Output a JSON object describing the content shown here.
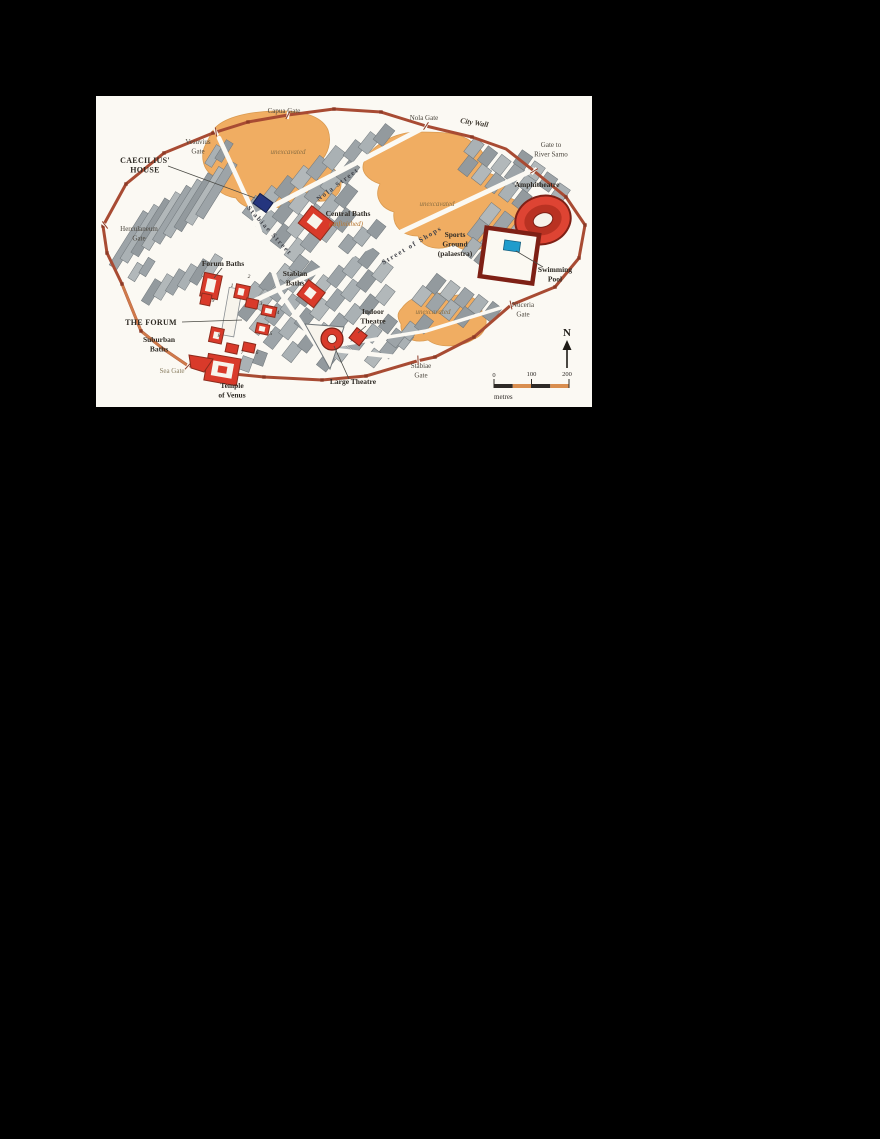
{
  "page": {
    "background": "#000000"
  },
  "map": {
    "colors": {
      "map_background": "#fbf9f3",
      "unexcavated_area": "#f0ad62",
      "city_block": "#9da4a8",
      "city_wall": "#a84b33",
      "public_building": "#d93a2a",
      "caecilius_house": "#24357e",
      "swimming_pool": "#1f9ccc"
    },
    "labels": [
      {
        "id": "capua-gate",
        "text": "Capua Gate",
        "x": 188,
        "y": 17,
        "cls": "gate"
      },
      {
        "id": "nola-gate",
        "text": "Nola Gate",
        "x": 328,
        "y": 24,
        "cls": "gate"
      },
      {
        "id": "city-wall",
        "text": "City Wall",
        "x": 378,
        "y": 29,
        "rot": 9,
        "cls": "wallname"
      },
      {
        "id": "gate-to-river-sarno",
        "text": "Gate to\nRiver Sarno",
        "x": 455,
        "y": 51,
        "cls": "gate"
      },
      {
        "id": "vesuvius-gate",
        "text": "Vesuvius\nGate",
        "x": 102,
        "y": 48,
        "cls": "gate"
      },
      {
        "id": "caecilius-house",
        "text": "CAECILIUS'\nHOUSE",
        "x": 49,
        "y": 67,
        "cls": "caps"
      },
      {
        "id": "herculaneum-gate",
        "text": "Herculaneum\nGate",
        "x": 43,
        "y": 135,
        "cls": "gate"
      },
      {
        "id": "unexcavated-nw",
        "text": "unexcavated",
        "x": 192,
        "y": 58,
        "cls": "unexc"
      },
      {
        "id": "nola-street",
        "text": "Nola Street",
        "x": 243,
        "y": 90,
        "rot": -37,
        "cls": "street"
      },
      {
        "id": "unexcavated-centre",
        "text": "unexcavated",
        "x": 341,
        "y": 110,
        "cls": "unexc"
      },
      {
        "id": "central-baths",
        "text": "Central Baths",
        "x": 252,
        "y": 120,
        "cls": "boldlbl"
      },
      {
        "id": "central-baths-note",
        "text": "(unfinished)",
        "x": 250,
        "y": 130,
        "cls": "unfin"
      },
      {
        "id": "stabiae-street",
        "text": "Stabiae Street",
        "x": 172,
        "y": 136,
        "rot": 48,
        "cls": "street"
      },
      {
        "id": "street-of-shops",
        "text": "Street of Shops",
        "x": 317,
        "y": 151,
        "rot": -31,
        "cls": "street"
      },
      {
        "id": "sports-ground",
        "text": "Sports\nGround\n(palaestra)",
        "x": 359,
        "y": 141,
        "cls": "boldlbl"
      },
      {
        "id": "amphitheatre",
        "text": "Amphitheatre",
        "x": 441,
        "y": 91,
        "cls": "boldlbl"
      },
      {
        "id": "swimming-pool",
        "text": "Swimming\nPool",
        "x": 459,
        "y": 176,
        "cls": "boldlbl"
      },
      {
        "id": "nuceria-gate",
        "text": "Nuceria\nGate",
        "x": 427,
        "y": 211,
        "cls": "gate"
      },
      {
        "id": "unexcavated-south",
        "text": "unexcavated",
        "x": 337,
        "y": 218,
        "cls": "unexc"
      },
      {
        "id": "indoor-theatre",
        "text": "Indoor\nTheatre",
        "x": 277,
        "y": 218,
        "cls": "boldlbl"
      },
      {
        "id": "large-theatre",
        "text": "Large Theatre",
        "x": 257,
        "y": 288,
        "cls": "boldlbl"
      },
      {
        "id": "stabiae-gate",
        "text": "Stabiae\nGate",
        "x": 325,
        "y": 272,
        "cls": "gate"
      },
      {
        "id": "forum-baths",
        "text": "Forum Baths",
        "x": 127,
        "y": 170,
        "cls": "boldlbl"
      },
      {
        "id": "stabian-baths",
        "text": "Stabian\nBaths",
        "x": 199,
        "y": 180,
        "cls": "boldlbl"
      },
      {
        "id": "the-forum",
        "text": "THE FORUM",
        "x": 55,
        "y": 229,
        "cls": "caps"
      },
      {
        "id": "suburban-baths",
        "text": "Suburban\nBaths",
        "x": 63,
        "y": 246,
        "cls": "boldlbl"
      },
      {
        "id": "sea-gate",
        "text": "Sea Gate",
        "x": 76,
        "y": 277,
        "cls": "seagate"
      },
      {
        "id": "temple-of-venus",
        "text": "Temple\nof Venus",
        "x": 136,
        "y": 292,
        "cls": "boldlbl"
      }
    ],
    "forum_numbers": [
      {
        "n": "1",
        "x": 136,
        "y": 191
      },
      {
        "n": "2",
        "x": 153,
        "y": 182
      },
      {
        "n": "3",
        "x": 165,
        "y": 209
      },
      {
        "n": "4",
        "x": 182,
        "y": 218
      },
      {
        "n": "5",
        "x": 175,
        "y": 239
      },
      {
        "n": "6",
        "x": 161,
        "y": 258
      },
      {
        "n": "7",
        "x": 146,
        "y": 258
      },
      {
        "n": "8",
        "x": 123,
        "y": 241
      },
      {
        "n": "9",
        "x": 117,
        "y": 206
      }
    ],
    "compass": {
      "label": "N"
    },
    "scale": {
      "ticks": [
        "0",
        "100",
        "200"
      ],
      "unit": "metres"
    }
  }
}
